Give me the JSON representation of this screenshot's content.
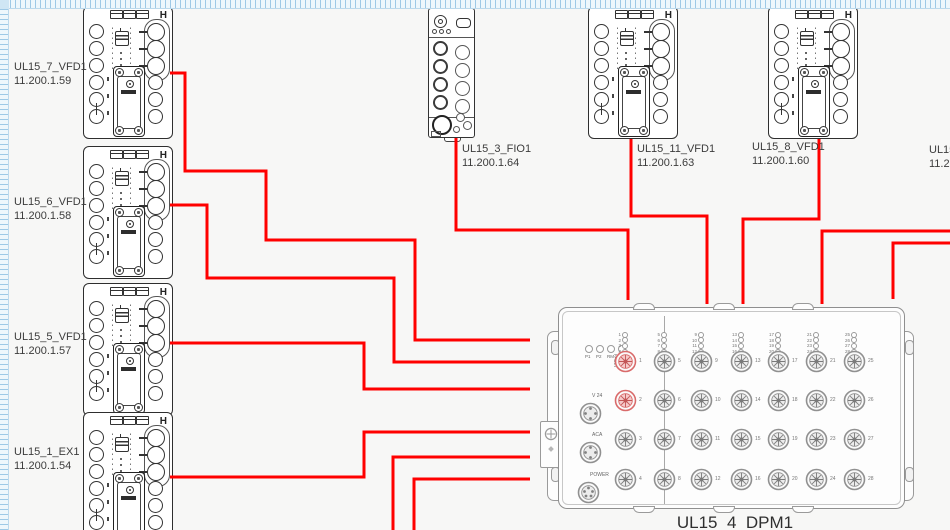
{
  "app": {
    "background": "#f7f7f6",
    "wire_color": "#ff0000",
    "highlight_color": "#d96a6a"
  },
  "vfd_h_marker": "H",
  "left_modules": [
    {
      "name": "UL15_7_VFD1",
      "ip": "11.200.1.59"
    },
    {
      "name": "UL15_6_VFD1",
      "ip": "11.200.1.58"
    },
    {
      "name": "UL15_5_VFD1",
      "ip": "11.200.1.57"
    },
    {
      "name": "UL15_1_EX1",
      "ip": "11.200.1.54"
    }
  ],
  "top_modules": [
    {
      "name": "UL15_3_FIO1",
      "ip": "11.200.1.64"
    },
    {
      "name": "UL15_11_VFD1",
      "ip": "11.200.1.63"
    },
    {
      "name": "UL15_8_VFD1",
      "ip": "11.200.1.60"
    }
  ],
  "partial_module": {
    "name": "UL15",
    "ip": "11.2"
  },
  "dpm": {
    "label": "UL15_4_DPM1",
    "status_leds": [
      "P1",
      "P2",
      "RM",
      "FAULT"
    ],
    "connector_labels": [
      "V 24",
      "ACA",
      "POWER"
    ],
    "port_columns": [
      [
        1,
        2,
        3,
        4
      ],
      [
        5,
        6,
        7,
        8
      ],
      [
        9,
        10,
        11,
        12
      ],
      [
        13,
        14,
        15,
        16
      ],
      [
        17,
        18,
        19,
        20
      ],
      [
        21,
        22,
        23,
        24
      ],
      [
        25,
        26,
        27,
        28
      ]
    ],
    "highlighted_ports": [
      1,
      2
    ]
  },
  "wires": [
    {
      "from": "UL15_7_VFD1",
      "points": [
        [
          170,
          73
        ],
        [
          185,
          73
        ],
        [
          185,
          171
        ],
        [
          266,
          171
        ],
        [
          266,
          240
        ],
        [
          415,
          240
        ],
        [
          415,
          340
        ],
        [
          530,
          340
        ]
      ]
    },
    {
      "from": "UL15_6_VFD1",
      "points": [
        [
          170,
          205
        ],
        [
          207,
          205
        ],
        [
          207,
          278
        ],
        [
          394,
          278
        ],
        [
          394,
          362
        ],
        [
          530,
          362
        ]
      ]
    },
    {
      "from": "UL15_5_VFD1",
      "points": [
        [
          170,
          343
        ],
        [
          364,
          343
        ],
        [
          364,
          389
        ],
        [
          530,
          389
        ]
      ]
    },
    {
      "from": "UL15_1_EX1",
      "points": [
        [
          170,
          477
        ],
        [
          364,
          477
        ],
        [
          364,
          432
        ],
        [
          530,
          432
        ]
      ]
    },
    {
      "from": "offscreen-bottom-1",
      "points": [
        [
          393,
          532
        ],
        [
          393,
          457
        ],
        [
          530,
          457
        ]
      ]
    },
    {
      "from": "offscreen-bottom-2",
      "points": [
        [
          414,
          532
        ],
        [
          414,
          479
        ],
        [
          530,
          479
        ]
      ]
    },
    {
      "from": "UL15_3_FIO1",
      "points": [
        [
          456,
          138
        ],
        [
          456,
          230
        ],
        [
          628,
          230
        ],
        [
          628,
          300
        ]
      ]
    },
    {
      "from": "UL15_11_VFD1",
      "points": [
        [
          631,
          139
        ],
        [
          631,
          216
        ],
        [
          707,
          216
        ],
        [
          707,
          304
        ]
      ]
    },
    {
      "from": "UL15_8_VFD1",
      "points": [
        [
          819,
          139
        ],
        [
          819,
          219
        ],
        [
          743,
          219
        ],
        [
          743,
          304
        ]
      ]
    },
    {
      "from": "offscreen-right-1",
      "points": [
        [
          952,
          231
        ],
        [
          822,
          231
        ],
        [
          822,
          304
        ]
      ]
    },
    {
      "from": "offscreen-right-2",
      "points": [
        [
          952,
          243
        ],
        [
          893,
          243
        ],
        [
          893,
          299
        ]
      ]
    }
  ]
}
